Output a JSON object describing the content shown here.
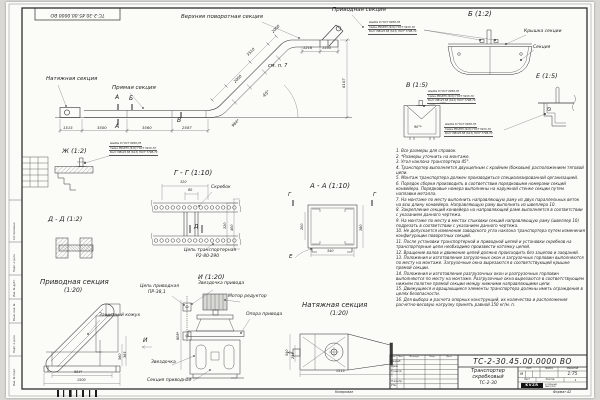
{
  "sheet": {
    "corner_stamp": "ТС-2-30.45.00.0000 ВО",
    "margin_labels": {
      "soglasovano": "Согласовано",
      "podp_data_1": "Подп. и дата",
      "inv_dubl": "Инв. № дубл.",
      "vzam_inv": "Взам. инв. №",
      "podp_data_2": "Подп. и дата",
      "inv_podl": "Инв. № подл."
    },
    "kopiroval": "Копировал",
    "format": "Формат А2"
  },
  "main_view": {
    "label_tension": "Натяжная секция",
    "label_straight": "Прямая секция",
    "label_upper_turn": "Верхняя поворотная секция",
    "label_drive": "Приводная секция",
    "see_note": "см. п. 7",
    "angle": "45°",
    "mark_a_top": "А",
    "mark_a_bottom": "А",
    "mark_b": "Б",
    "mark_v": "В",
    "dim_1515": "1515",
    "dim_3500": "3500",
    "dim_3560": "3560",
    "dim_2587": "2587",
    "dim_984": "984*",
    "dim_2000a": "2000",
    "dim_3510": "3510",
    "dim_2000b": "2000",
    "dim_1216": "1216",
    "dim_1505": "1505",
    "dim_height": "6107"
  },
  "callout": {
    "line1": "Шайба 8 ГОСТ 6958-78",
    "line2": "Гайка М8-6Н5 (S13) ГОСТ 5915-70",
    "line3": "Болт М8х25.58 (S13) ГОСТ 7798-70"
  },
  "details": {
    "zh_title": "Ж (1:2)",
    "b_title": "Б (1:2)",
    "b_label_cover": "Крышка секции",
    "b_label_section": "Секция",
    "v_title": "В (1:5)",
    "v_dim_angle": "90°*",
    "e_title": "Е (1:5)",
    "dd_title": "Д - Д (1:2)",
    "gg_title": "Г - Г (1:10)",
    "gg_label_scraper": "Скребок",
    "gg_chain_1": "Цепь транспортерная",
    "gg_chain_2": "Р2-80-290",
    "gg_mark_d": "Д",
    "gg_dim_320t": "320",
    "gg_dim_80": "80",
    "gg_dim_320r": "320",
    "gg_dim_400": "400",
    "aa_title": "А - А (1:10)",
    "aa_mark_g_left": "Г",
    "aa_mark_g_right": "Г",
    "aa_mark_e": "Е",
    "aa_dim_200": "200",
    "aa_dim_340": "340",
    "aa_dim_380": "380",
    "drive_title": "Приводная секция",
    "drive_scale": "(1:20)",
    "drive_label_cover": "Защитный кожух",
    "drive_mark_i": "И",
    "drive_dim_560": "560",
    "drive_dim_365": "365",
    "drive_dim_984": "984*",
    "drive_dim_1500": "1500",
    "i_title": "И (1:20)",
    "i_chain_1": "Цепь приводная",
    "i_chain_2": "ПР-38,1",
    "i_sprocket_drive": "Звездочка привода",
    "i_motor": "Мотор редуктор",
    "i_support": "Опора привода",
    "i_sprocket": "Звездочка",
    "i_section": "Секция приводная",
    "i_dim_808": "808*",
    "t_title": "Натяжная секция",
    "t_scale": "(1:20)",
    "t_dim_540": "540",
    "t_dim_255": "255",
    "t_dim_1515": "1515"
  },
  "notes": [
    "1. Все размеры для справок.",
    "2. *Размеры уточнить на монтаже.",
    "3. Угол наклона транспортера 45°.",
    "4. Транспортер выполняется двухцепным с крайним (боковым) расположением тяговой цепи.",
    "5. Монтаж транспортера должен производиться специализированной организацией.",
    "6. Порядок сборки производить в соответствии порядковыми номерами секций конвейера. Порядковые номера выполнены на наружной стенке секции путем наплавки металла.",
    "7. На монтаже по месту выполнить направляющую раму из двух параллельных веток на всю длину конвейера. Направляющую раму выполнить из швеллера 10.",
    "8. Закрепление секций конвейера на направляющей раме выполняется в соответствии с указанием данного чертежа.",
    "9. На монтаже по месту в местах стыковки секций направляющую раму (швеллер 10) подрезать в соответствии с указанием данного чертежа.",
    "10. Не допускается изменение заводского угла наклона транспортера путем изменения конфигурации поворотных секций.",
    "11. После установки транспортерной и приводной цепей и установки скребков на транспортерные цепи необходимо произвести натяжку цепей.",
    "12. Вращение валов и движение цепей должно происходить без зацепов и заеданий.",
    "13. Положения и изготовление загрузочных окон и загрузочных горловин выполняются по месту на монтаже. Загрузочные окна вырезаются в соответствующей крышке прямой секции.",
    "14. Положения и изготовление разгрузочных окон и разгрузочных горловин выполняются по месту на монтаже. Разгрузочные окна вырезаются в соответствующем нижнем полотне прямой секции между нижними направляющими цепи.",
    "15. Движущиеся и вращающиеся элементы транспортера должны иметь ограждения в целях безопасности.",
    "16. Для выбора и расчета опорных конструкций, их количества и расположения расчетно-весовую нагрузку принять равной 150 кг/м. п."
  ],
  "title_block": {
    "doc_number": "ТС-2-30.45.00.0000 ВО",
    "name_1": "Транспортер",
    "name_2": "скребковый",
    "name_3": "ТС-2-30",
    "col_izm": "Изм.",
    "col_list": "Лист",
    "col_docum": "№ докум.",
    "col_podp": "Подп.",
    "col_data": "Дата",
    "row_razrab": "Разраб.",
    "row_prov": "Пров.",
    "row_tkontr": "Т.контр.",
    "row_nkontr": "Н.контр.",
    "row_utv": "Утв.",
    "lit_label": "Лит.",
    "mass_label": "Масса",
    "scale_label": "Масштаб",
    "lit_value": "М",
    "scale_value": "1:75",
    "sheet_label": "Лист",
    "sheets_label": "Листов",
    "sheets_value": "1",
    "logo_text": "KVZR",
    "logo_sub_1": "КОТЕЛЬНЫЙ",
    "logo_sub_2": "ЗАВОД РЭП"
  }
}
